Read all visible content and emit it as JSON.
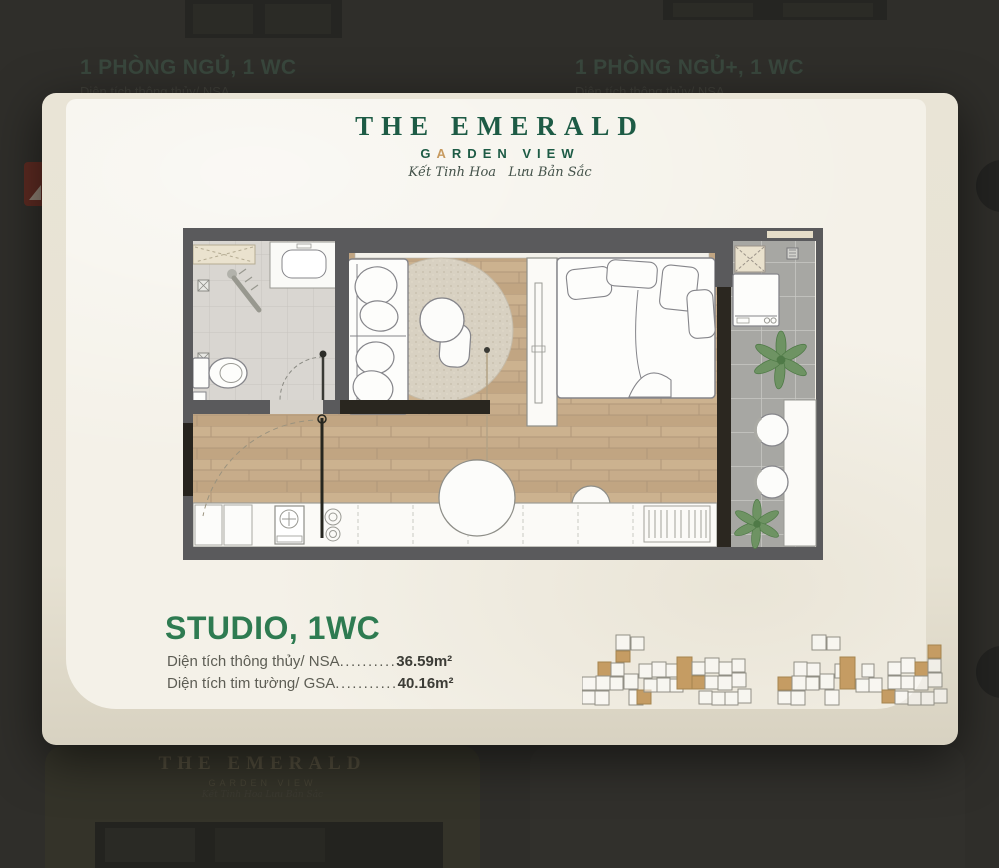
{
  "modal": {
    "logo": {
      "title": "THE EMERALD",
      "subtitle_g": "G",
      "subtitle_a": "A",
      "subtitle_rest": "RDEN VIEW",
      "tagline": "Kết Tinh Hoa   Lưu Bản Sắc"
    },
    "unit_title": "STUDIO, 1WC",
    "areas": [
      {
        "label": "Diện tích thông thủy/ NSA",
        "dots": "..........",
        "value": "36.59m²"
      },
      {
        "label": "Diện tích tim tường/ GSA",
        "dots": "...........",
        "value": "40.16m²"
      }
    ],
    "colors": {
      "accent_green": "#2e7b51",
      "logo_green": "#1d5b45",
      "logo_gold": "#c79a5f",
      "keyplan_highlight": "#c59c63"
    }
  },
  "background": {
    "top_left_card": {
      "title": "1 PHÒNG NGỦ, 1 WC",
      "area_label": "Diện tích thông thủy/ NSA",
      "area_dots": ".........."
    },
    "top_right_card": {
      "title": "1 PHÒNG NGỦ+, 1 WC",
      "area_label": "Diện tích thông thủy/ NSA",
      "area_dots": ".........."
    },
    "bottom_card": {
      "logo_title": "THE EMERALD",
      "logo_subtitle": "GARDEN VIEW",
      "logo_tagline": "Kết Tinh Hoa   Lưu Bản Sắc"
    }
  }
}
